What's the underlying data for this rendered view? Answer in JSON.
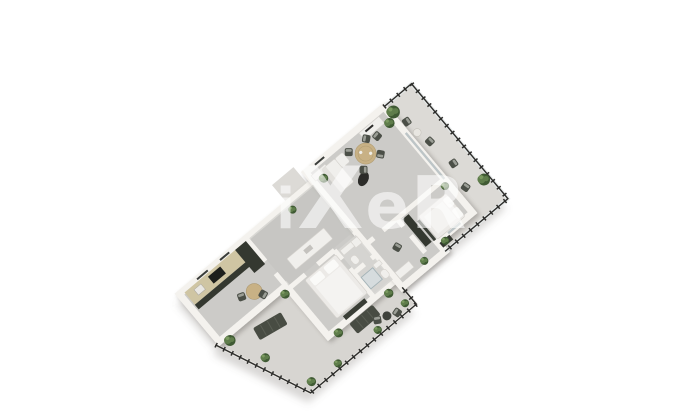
{
  "watermark": {
    "text": "iXeR",
    "letters": [
      "i",
      "X",
      "e",
      "R"
    ]
  },
  "palette": {
    "background": "#ffffff",
    "wall": "#f4f2ee",
    "floor": "#cccbc8",
    "hall_floor": "#c3c2bf",
    "bath_floor": "#d6d5d2",
    "balcony_floor": "#dcdad6",
    "terrace_floor": "#d7d5d1",
    "railing": "#2d2d2b",
    "glass": "rgba(228,233,235,0.55)",
    "plant": "#5f7d4b",
    "plant_dark": "#3f5a33",
    "plant_light": "#7b9a60",
    "counter": "#cfc5a3",
    "cabinet": "#343830",
    "wood": "#c8b185",
    "white_furniture": "#f0efec",
    "dark_furniture": "#3a3e36",
    "chair": "#4b4f47",
    "lounger": "#484c43",
    "bed": "#eceae7",
    "shadow": "rgba(104,100,94,0.26)",
    "watermark": "rgba(255,255,255,0.58)"
  }
}
